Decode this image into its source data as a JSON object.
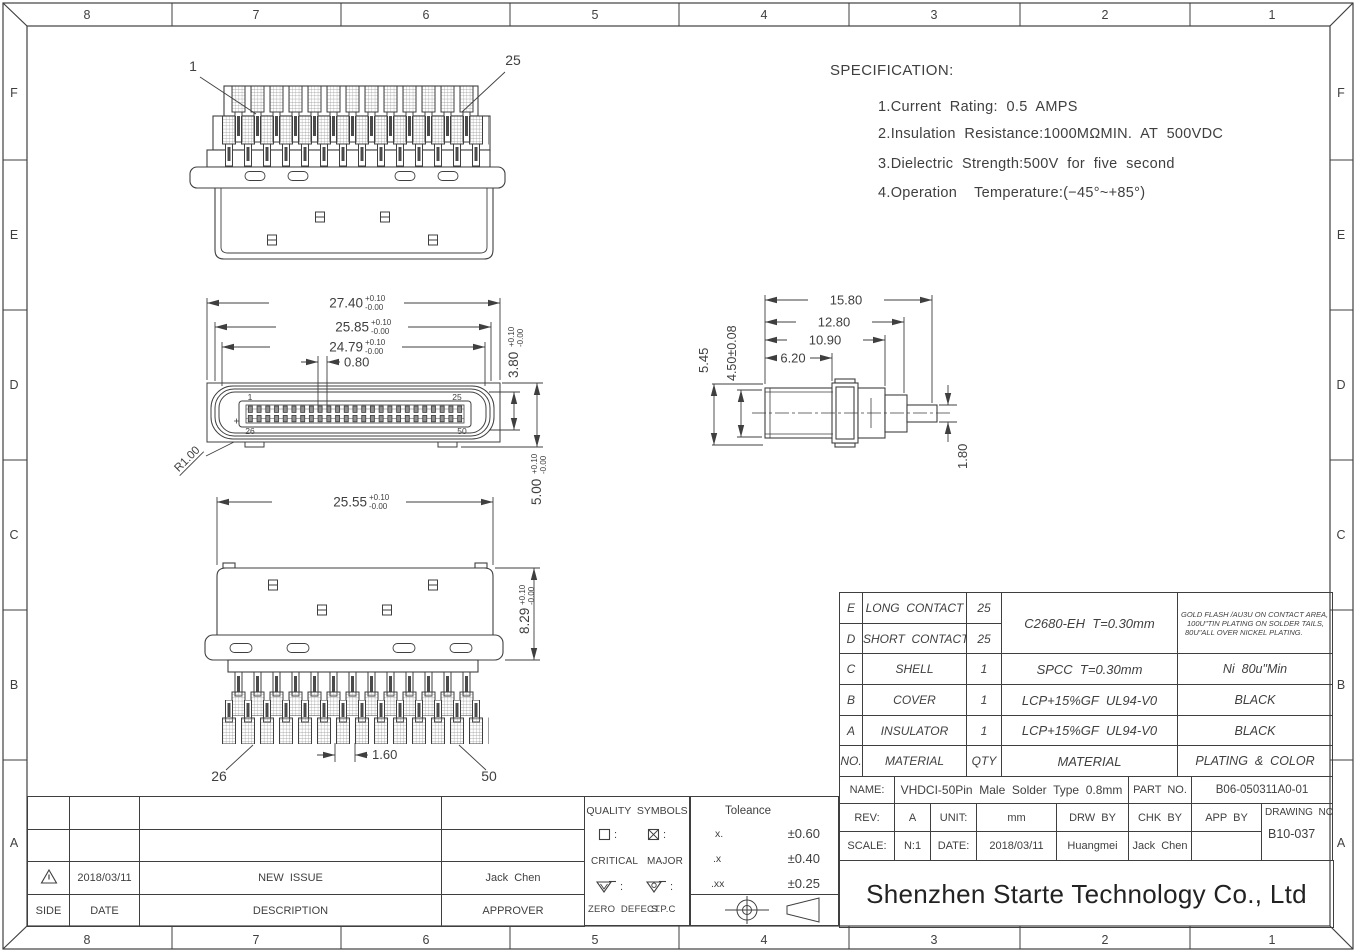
{
  "sheet": {
    "grid_cols": [
      "8",
      "7",
      "6",
      "5",
      "4",
      "3",
      "2",
      "1"
    ],
    "grid_rows": [
      "F",
      "E",
      "D",
      "C",
      "B",
      "A"
    ]
  },
  "specification": {
    "title": "SPECIFICATION:",
    "items": [
      "1.Current  Rating:  0.5  AMPS",
      "2.Insulation  Resistance:1000MΩMIN.  AT  500VDC",
      "3.Dielectric  Strength:500V  for  five  second",
      "4.Operation    Temperature:(−45°~+85°)"
    ]
  },
  "dimensions": {
    "top_view": {
      "pin_first": "1",
      "pin_last": "25"
    },
    "front_view": {
      "width_shell": {
        "v": "27.40",
        "tp": "+0.10",
        "tm": "-0.00"
      },
      "width_rim": {
        "v": "25.85",
        "tp": "+0.10",
        "tm": "-0.00"
      },
      "width_cavity": {
        "v": "24.79",
        "tp": "+0.10",
        "tm": "-0.00"
      },
      "pin_pitch": "0.80",
      "cavity_height": {
        "v": "3.80",
        "tp": "+0.10",
        "tm": "-0.00"
      },
      "shell_height": {
        "v": "5.00",
        "tp": "+0.10",
        "tm": "-0.00"
      },
      "corner_radius": "R1.00",
      "pin_tl": "1",
      "pin_tr": "25",
      "pin_bl": "26",
      "pin_br": "50"
    },
    "bottom_view": {
      "body_width": {
        "v": "25.55",
        "tp": "+0.10",
        "tm": "-0.00"
      },
      "body_height": {
        "v": "8.29",
        "tp": "+0.10",
        "tm": "-0.00"
      },
      "tail_pitch": "1.60",
      "pin_first": "26",
      "pin_last": "50"
    },
    "side_view": {
      "len_total": "15.80",
      "len_step": "12.80",
      "len_block": "10.90",
      "len_body": "6.20",
      "h_flange": "5.45",
      "h_body": "4.50±0.08",
      "tail_thickness": "1.80"
    }
  },
  "bom": {
    "contact_material": "C2680-EH  T=0.30mm",
    "contact_plating_lines": [
      "GOLD FLASH /AU3U ON CONTACT AREA,",
      "100U\"TIN PLATING ON SOLDER TAILS,",
      "80U\"ALL OVER NICKEL PLATING."
    ],
    "rows": [
      {
        "no": "E",
        "part": "LONG  CONTACT",
        "qty": "25"
      },
      {
        "no": "D",
        "part": "SHORT  CONTACT",
        "qty": "25"
      },
      {
        "no": "C",
        "part": "SHELL",
        "qty": "1",
        "material": "SPCC  T=0.30mm",
        "plating": "Ni  80u\"Min"
      },
      {
        "no": "B",
        "part": "COVER",
        "qty": "1",
        "material": "LCP+15%GF  UL94-V0",
        "plating": "BLACK"
      },
      {
        "no": "A",
        "part": "INSULATOR",
        "qty": "1",
        "material": "LCP+15%GF  UL94-V0",
        "plating": "BLACK"
      },
      {
        "no": "NO.",
        "part": "MATERIAL",
        "qty": "QTY",
        "material": "MATERIAL",
        "plating": "PLATING  &  COLOR"
      }
    ]
  },
  "title_block": {
    "name_label": "NAME:",
    "name_value": "VHDCI-50Pin  Male  Solder  Type  0.8mm",
    "part_label": "PART  NO.",
    "part_value": "B06-050311A0-01",
    "rev_label": "REV:",
    "rev_value": "A",
    "unit_label": "UNIT:",
    "unit_value": "mm",
    "drw_label": "DRW  BY",
    "chk_label": "CHK  BY",
    "app_label": "APP  BY",
    "drawing_no_label": "DRAWING  NO.",
    "scale_label": "SCALE:",
    "scale_value": "N:1",
    "date_label": "DATE:",
    "date_value": "2018/03/11",
    "drw_value": "Huangmei",
    "chk_value": "Jack  Chen",
    "app_value": "",
    "drawing_no_value": "B10-037"
  },
  "revision": {
    "rows": [
      {
        "date": "2018/03/11",
        "description": "NEW  ISSUE",
        "approver": "Jack  Chen"
      }
    ],
    "header": {
      "side": "SIDE",
      "date": "DATE",
      "description": "DESCRIPTION",
      "approver": "APPROVER"
    }
  },
  "quality": {
    "title": "QUALITY  SYMBOLS",
    "colon": ":",
    "critical_label": "CRITICAL",
    "major_label": "MAJOR",
    "zero_defect_label": "ZERO  DEFECT",
    "spc_label": "S.P.C"
  },
  "tolerance": {
    "title": "Toleance",
    "rows": [
      {
        "k": "x.",
        "v": "±0.60"
      },
      {
        "k": ".x",
        "v": "±0.40"
      },
      {
        "k": ".xx",
        "v": "±0.25"
      }
    ]
  },
  "company": {
    "name": "Shenzhen Starte Technology Co., Ltd"
  }
}
